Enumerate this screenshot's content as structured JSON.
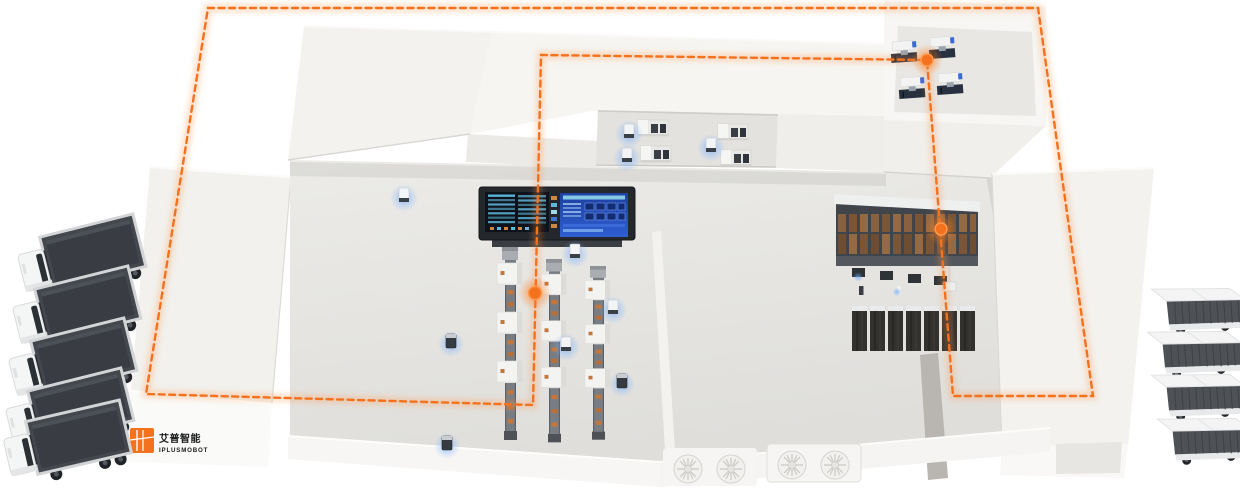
{
  "scene": {
    "kind": "isometric-smart-factory-overview",
    "background": "#ffffff"
  },
  "brand": {
    "logo_cn": "艾普智能",
    "logo_en": "IPLUSMOBOT",
    "logo_color": "#F4711E",
    "text_color": "#1B1C1E"
  },
  "route": {
    "color": "#F4711E",
    "dash": "6 4.5",
    "width": "2.4",
    "points": "208,8 1038,8 1093,396 953,396 927,60 541,55 533,405 146,394",
    "waypoints": [
      {
        "x": "535",
        "y": "293"
      },
      {
        "x": "927",
        "y": "60"
      },
      {
        "x": "941",
        "y": "229"
      }
    ]
  },
  "fleet": {
    "left_dock_trucks": 5,
    "right_dock_trucks": 4
  },
  "equipment": {
    "production_lines": 3,
    "machining_cells_top_right": 4,
    "test_benches_mid_room": 4,
    "storage_rack_bays": 13,
    "dark_cabinets": 7,
    "mobile_robots": 14,
    "hvac_fan_units": 4
  },
  "display": {
    "central_dashboard": "dual-screen-panel"
  }
}
